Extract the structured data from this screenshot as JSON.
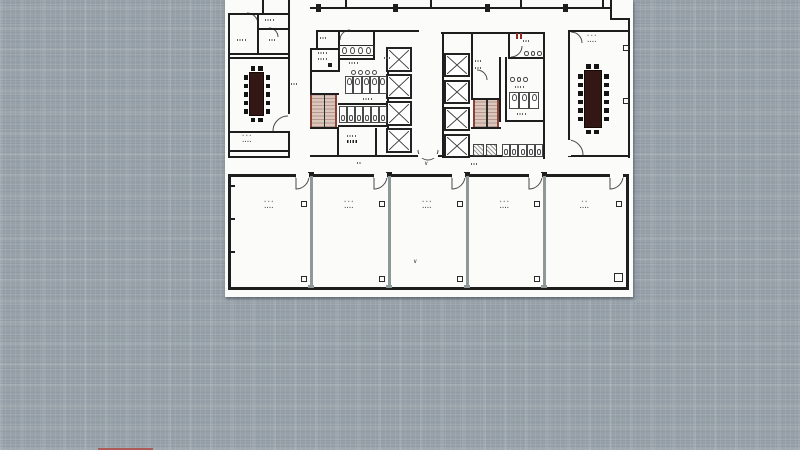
{
  "window": {
    "width": 800,
    "height": 450
  },
  "background": {
    "base_color": "#96a0a8",
    "weave_line_color": "#aeb6bd"
  },
  "plan": {
    "paper_color": "#fbfbf9",
    "wall_color": "#1e1e1e",
    "partition_color": "#8f9898",
    "door_arc_color": "#4a4a4a",
    "stair_fill": "#dcc7bd",
    "stair_edge": "#8e4034",
    "table_color": "#321714",
    "chair_color": "#141414",
    "red_mark_color": "#8e2b22",
    "left_conference_label": {
      "line1": "∙∙∙",
      "line2": "∙∙∙∙"
    },
    "right_conference_label": {
      "line1": "∙∙∙",
      "line2": "∙∙∙∙"
    },
    "bottom_rooms": [
      {
        "id": "room-1",
        "line1": "∙∙∙",
        "line2": "∙∙∙∙"
      },
      {
        "id": "room-2",
        "line1": "∙∙∙",
        "line2": "∙∙∙∙"
      },
      {
        "id": "room-3",
        "line1": "∙∙∙",
        "line2": "∙∙∙∙"
      },
      {
        "id": "room-4",
        "line1": "∙∙∙",
        "line2": "∙∙∙∙"
      },
      {
        "id": "room-5",
        "line1": "∙∙",
        "line2": "∙∙∙∙"
      }
    ],
    "direction_mark": "∨"
  },
  "artifacts": {
    "bottom_edge_color": "#b04038"
  }
}
